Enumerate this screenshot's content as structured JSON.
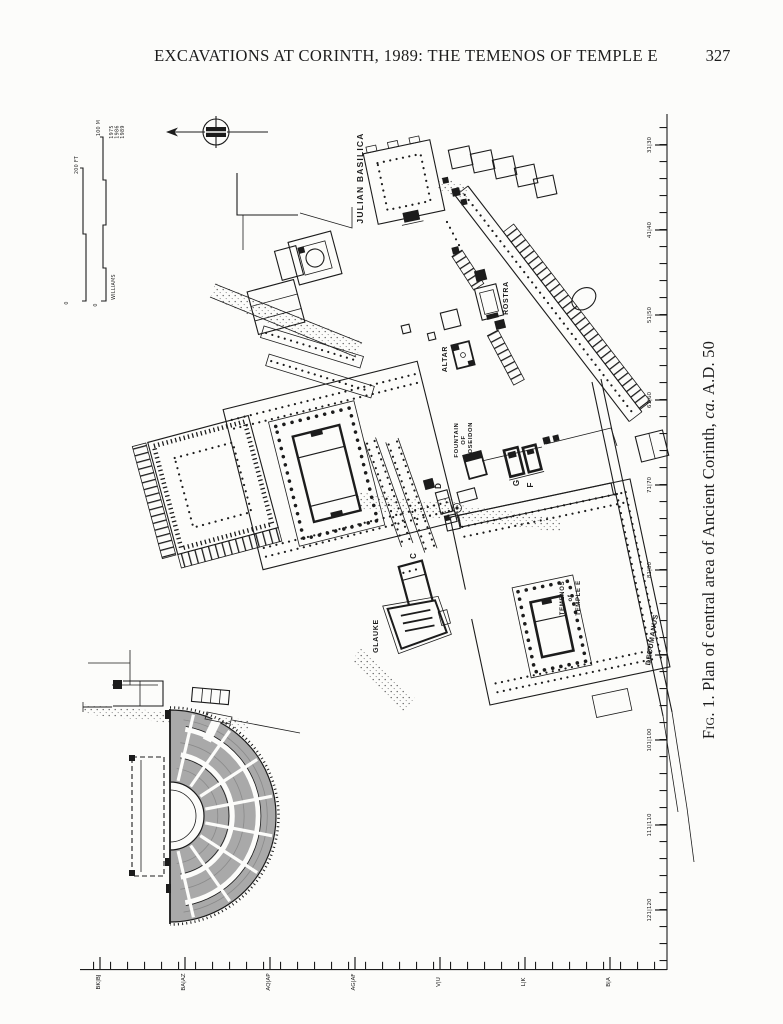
{
  "page": {
    "header_title": "EXCAVATIONS AT CORINTH, 1989: THE TEMENOS OF TEMPLE E",
    "page_number": "327",
    "caption": {
      "fig": "Fig. 1.",
      "body": " Plan of central area of Ancient Corinth, ",
      "circa": "ca.",
      "date": " A.D. 50"
    }
  },
  "plan": {
    "scale_bar": {
      "feet_label": "200 FT",
      "feet_zero": "0",
      "meters_label": "100 M",
      "meters_zero": "0",
      "credit": "WILLIAMS",
      "years": [
        "1975",
        "1986",
        "1989"
      ]
    },
    "labels": {
      "julian_basilica": "JULIAN BASILICA",
      "rostra": "ROSTRA",
      "altar": "ALTAR",
      "fountain_line1": "FOUNTAIN",
      "fountain_line2": "OF",
      "fountain_line3": "POSEIDON",
      "glauke": "GLAUKE",
      "temenos_line1": "TEMENOS",
      "temenos_line2": "of",
      "temenos_line3": "TEMPLE E",
      "decumanus": "DECUMANUS",
      "temple_c": "C",
      "monument_d": "D",
      "temple_g": "G",
      "temple_f": "F"
    },
    "grid": {
      "right_labels": [
        "31|30",
        "41|40",
        "51|50",
        "61|60",
        "71|70",
        "81|80",
        "91|90",
        "101|100",
        "111|110",
        "121|120"
      ],
      "bottom_labels": [
        "BK|BJ",
        "BA|AZ",
        "AQ|AP",
        "AG|AF",
        "V|U",
        "L|K",
        "B|A"
      ]
    },
    "colors": {
      "paper": "#fcfcfa",
      "ink": "#1c1c1c",
      "gray": "#a9a9a9"
    }
  }
}
